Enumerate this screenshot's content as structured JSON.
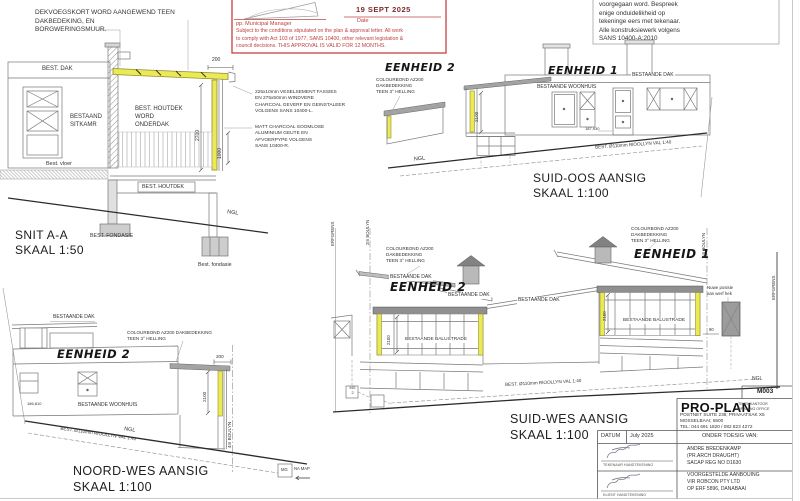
{
  "sheet": {
    "number": "M003"
  },
  "colors": {
    "highlight_yellow": "#ecea54",
    "stamp_red": "#c04040",
    "roof_grey": "#8f8f8f"
  },
  "general_notes": {
    "top_left": "DEKVOEGSKORT WORD AANGEWEND TEEN\nDAKBEDEKING, EN\nBORGWERINGSMUUR.",
    "top_right": "voorgegaan word.  Bespreek\nenige onduidelikheid op\ntekeninge eers met tekenaar.\nAlle konstruksiewerk volgens\nSANS 10400-A:2010"
  },
  "approval_stamp": {
    "pp_line": "pp. Municipal Manager",
    "date_value": "19 SEPT 2025",
    "date_label": "Date",
    "conditions": "Subject to the conditions stipulated on the plan & approval letter. All work\nto comply with Act 103 of 1977, SANS 10400, other relevant legislation &\ncouncil decisions.      THIS APPROVAL IS VALID FOR 12 MONTHS."
  },
  "material_notes": {
    "fascia": "225x10mm VESELSEMENT FASSIES\nEN 275x50mm WINDVERE\nCHARCOAL GEVERF EN GEINSTALEER\nVOLGENS SANS 10400-L.",
    "gutter": "MATT CHARCOAL SOOMLOSE\nALUMINIUM GEUTE EN\nAFVOERPYPE VOLGENS\nSANS 10400-R."
  },
  "snit_aa": {
    "title": "SNIT A-A",
    "scale": "SKAAL 1:50",
    "labels": {
      "best_dak": "BEST. DAK",
      "sitkamer": "BESTAAND\nSITKAMR",
      "best_vloer": "Best. vloer",
      "houtdek_word_onderdak": "BEST. HOUTDEK\nWORD\nONDERDAK",
      "best_houtdek": "BEST. HOUTDEK",
      "best_fondasie": "BEST. FONDASIE",
      "best_fondasie_klein": "Best. fondasie",
      "ngl": "NGL"
    },
    "dims": {
      "d200": "200",
      "d2700": "2700",
      "d1000": "1000"
    }
  },
  "suid_oos": {
    "title": "SUID-OOS AANSIG",
    "scale": "SKAAL 1:100",
    "eenheid_2": "EENHEID 2",
    "eenheid_1": "EENHEID 1",
    "colourbond_note": "COLOURBOND AZ200\nDAKBEDEKKING\nTEEN 3° HELLING",
    "bestaande_dak": "BESTAANDE DAK",
    "bestaande_woonhuis": "BESTAANDE WOONHUIS",
    "level": "187,930",
    "riool": "BEST. Ø110mm RIOOLLYN VAL 1:40",
    "ngl": "NGL",
    "dim_2100": "2100"
  },
  "noord_wes": {
    "title": "NOORD-WES AANSIG",
    "scale": "SKAAL 1:100",
    "eenheid_2": "EENHEID 2",
    "bestaande_dak": "BESTAANDE DAK",
    "colourbond_note": "COLOURBOND AZ200 DAKBEDEKKING\nTEEN 3° HELLING",
    "bestaande_woonhuis": "BESTAANDE WOONHUIS",
    "level": "186,810",
    "riool": "BEST. Ø110mm RIOOLLYN VAL 1:40",
    "ngl": "NGL",
    "boulyn_4m": "4m BOULYN",
    "dim_200": "200",
    "dim_2100": "2100",
    "mg": "MG",
    "na_map": "NA MAP"
  },
  "suid_wes": {
    "title": "SUID-WES AANSIG",
    "scale": "SKAAL 1:100",
    "eenheid_2": "EENHEID 2",
    "eenheid_1": "EENHEID 1",
    "colourbond_note_2": "COLOURBOND AZ200\nDAKBEDEKKING\nTEEN 3° HELLING",
    "colourbond_note_1": "COLOURBOND AZ200\nDAKBEDEKKING\nTEEN 3° HELLING",
    "bestaande_dak_1": "BESTAANDE DAK",
    "bestaande_dak_2": "BESTAANDE DAK",
    "bestaande_dak_3": "BESTAANDE DAK",
    "balustrade_links": "BESTAANDE BALUSTRADE",
    "balustrade_regs": "BESTAANDE BALUSTRADE",
    "erfgrens_links": "ERFGRENS",
    "erfgrens_regs": "ERFGRENS",
    "boulyn_2m": "2m BOULYN",
    "boulyn_4m": "4m BOULYN",
    "hek_note": "Nuwe posisie\nvan werf hek",
    "riool": "BEST. Ø110mm RIOOLLYN VAL 1:40",
    "ngl": "NGL",
    "dim_2100_links": "2100",
    "dim_2100_regs": "2100",
    "dim_90": "90",
    "mg_2": "MG\n2"
  },
  "title_block": {
    "sheet_no": "M003",
    "brand": "PRO-PLAN",
    "brand_sub": "TEKENKANTOOR\nDRAWING OFFICE",
    "address": "POSTNET SUITE 238; PRIVAATSAK X5\nMOSSELBAAI; 6500\nTEL: 044 691 1820 / 082 823 4272",
    "datum_label": "DATUM",
    "datum_value": "July 2025",
    "onder_toesig": "ONDER TOESIG VAN:",
    "tekenaar_sig_label": "TEKENAAR HANDTEKENING",
    "architect": "ANDRE BREDENKAMP\n(PR.ARCH DRAUGHT)\nSACAP REG NO D1630",
    "klient_sig_label": "KLIENT HANDTEKENING",
    "project": "VOORGESTELDE AANBOUING\nVIR ROBCON PTY LTD\nOP ERF 5896, DANABAAI"
  }
}
